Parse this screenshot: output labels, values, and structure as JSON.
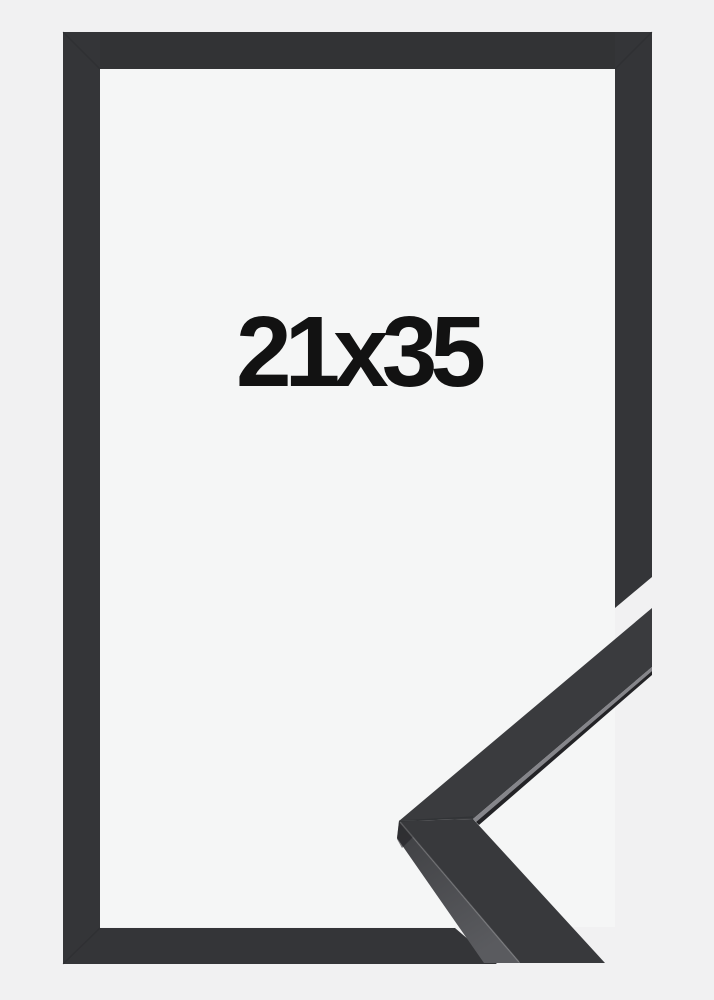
{
  "product": {
    "size_label": "21x35"
  },
  "colors": {
    "background": "#f1f1f2",
    "inner_area": "#f5f6f6",
    "frame_bar": "#343538",
    "frame_bar_top": "#323335",
    "sample_face": "#3a3b3e",
    "sample_face_lower": "#38393c",
    "sample_side_top": "#3e3f42",
    "sample_side_bottom": "#5a5b5f",
    "sample_edge_light": "#85858a",
    "sample_edge_dark": "#232326",
    "miter_seam": "#26272a",
    "text": "#121212"
  }
}
